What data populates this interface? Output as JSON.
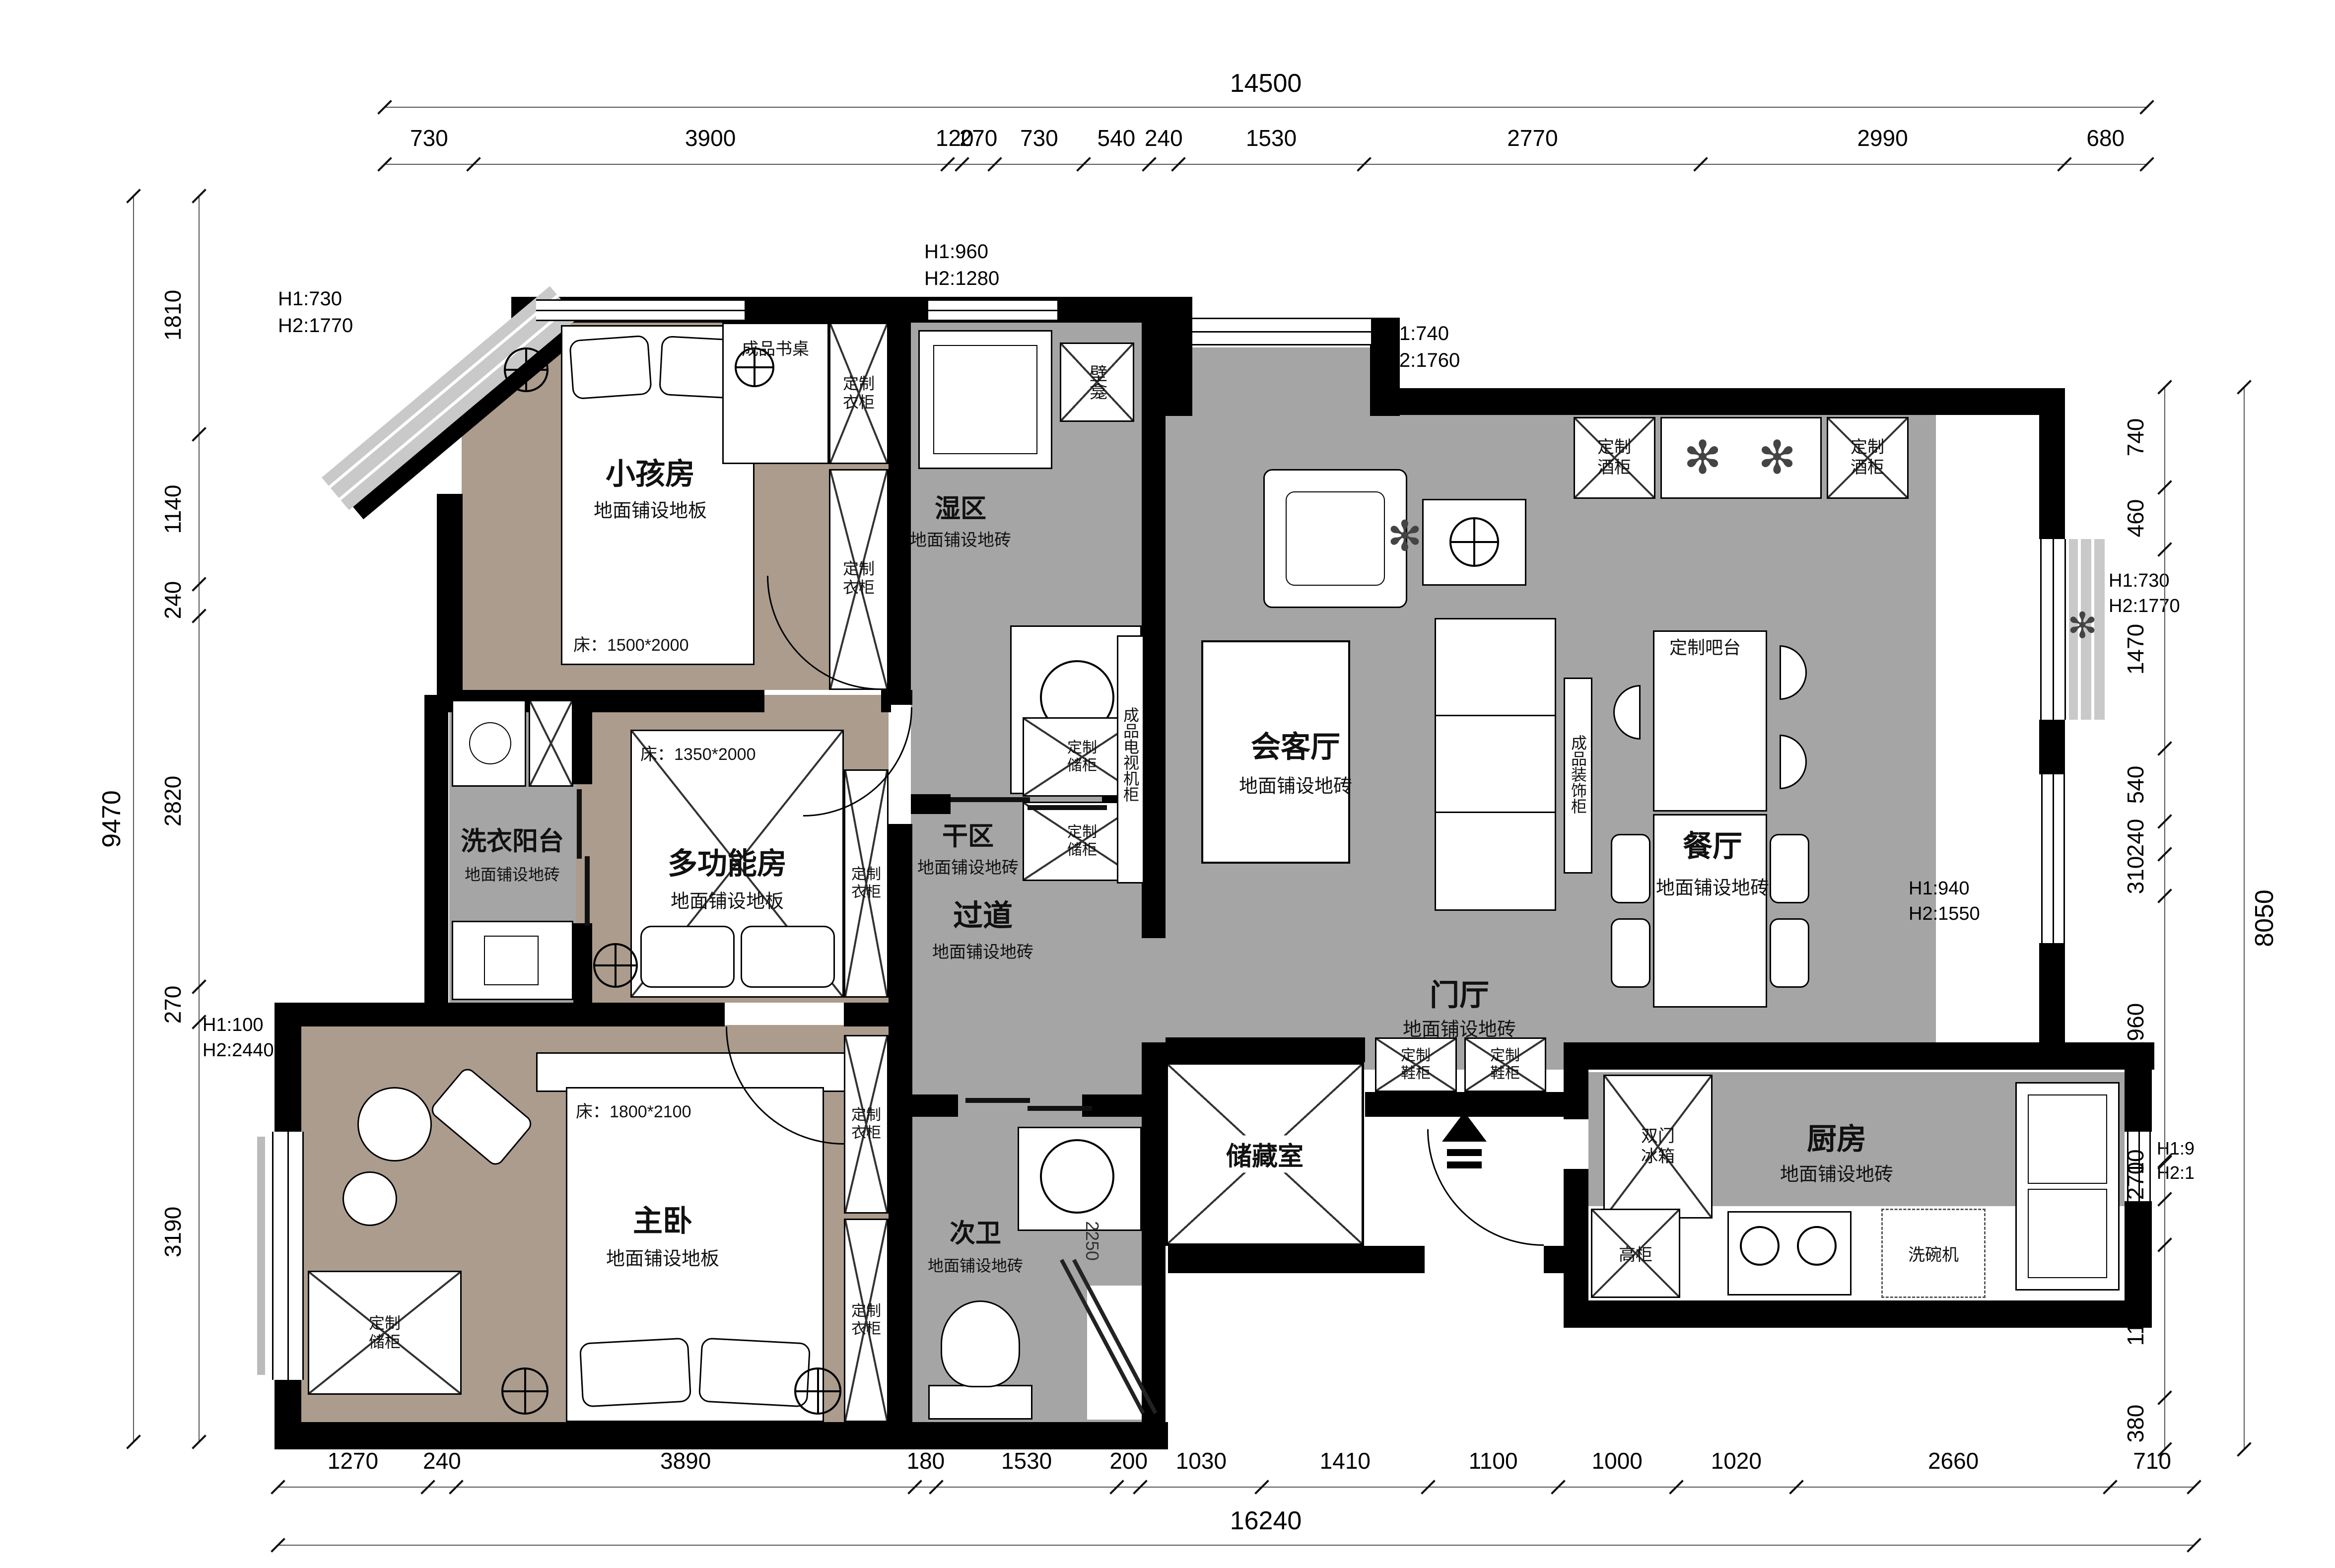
{
  "plan": {
    "colors": {
      "wall": "#000000",
      "wood": "#ab9c8d",
      "tile": "#a5a5a5",
      "bay": "#c9c9c9"
    },
    "rooms": {
      "children": {
        "name": "小孩房",
        "floor": "地面铺设地板",
        "bed": "床：1500*2000"
      },
      "wet": {
        "name": "湿区",
        "floor": "地面铺设地砖"
      },
      "dry": {
        "name": "干区",
        "floor": "地面铺设地砖"
      },
      "living": {
        "name": "会客厅",
        "floor": "地面铺设地砖"
      },
      "dining": {
        "name": "餐厅",
        "floor": "地面铺设地砖"
      },
      "laundry": {
        "name": "洗衣阳台",
        "floor": "地面铺设地砖"
      },
      "multi": {
        "name": "多功能房",
        "floor": "地面铺设地板",
        "bed": "床：1350*2000"
      },
      "corridor": {
        "name": "过道",
        "floor": "地面铺设地砖"
      },
      "foyer": {
        "name": "门厅",
        "floor": "地面铺设地砖"
      },
      "storage": {
        "name": "储藏室"
      },
      "master": {
        "name": "主卧",
        "floor": "地面铺设地板",
        "bed": "床：1800*2100"
      },
      "bath2": {
        "name": "次卫",
        "floor": "地面铺设地砖"
      },
      "kitchen": {
        "name": "厨房",
        "floor": "地面铺设地砖"
      }
    },
    "labels": {
      "wardrobe": "定制衣柜",
      "wine": "定制酒柜",
      "shoe": "定制鞋柜",
      "store_cab": "定制储柜",
      "bar": "定制吧台",
      "desk": "成品书桌",
      "tv_cab": "成品电视机柜",
      "deco_cab": "成品装饰柜",
      "niche": "壁龛",
      "fridge": "双门冰箱",
      "tall_cab": "高柜",
      "dishwasher": "洗碗机"
    },
    "ann": {
      "a1": {
        "l1": "H1:730",
        "l2": "H2:1770"
      },
      "a2": {
        "l1": "H1:960",
        "l2": "H2:1280"
      },
      "a3": {
        "l1": "H1:740",
        "l2": "H2:1760"
      },
      "a4": {
        "l1": "H1:730",
        "l2": "H2:1770"
      },
      "a5": {
        "l1": "H1:940",
        "l2": "H2:1550"
      },
      "a6": {
        "l1": "H1:100",
        "l2": "H2:2440"
      },
      "a7": {
        "l1": "H1:9",
        "l2": "H2:1"
      }
    },
    "dimensions": {
      "top_total": "14500",
      "top": [
        "730",
        "3900",
        "120",
        "270",
        "730",
        "540",
        "240",
        "1530",
        "2770",
        "2990",
        "680"
      ],
      "bottom_total": "16240",
      "bottom": [
        "1270",
        "240",
        "3890",
        "180",
        "1530",
        "200",
        "1030",
        "1410",
        "1100",
        "1000",
        "1020",
        "2660",
        "710"
      ],
      "left_total": "9470",
      "left": [
        "1810",
        "1140",
        "240",
        "2820",
        "270",
        "3190"
      ],
      "right_total": "8050",
      "right": [
        "740",
        "460",
        "1470",
        "540",
        "240",
        "310",
        "1960",
        "10",
        "270",
        "340",
        "1130",
        "380"
      ],
      "bath2_width": "2250"
    }
  }
}
